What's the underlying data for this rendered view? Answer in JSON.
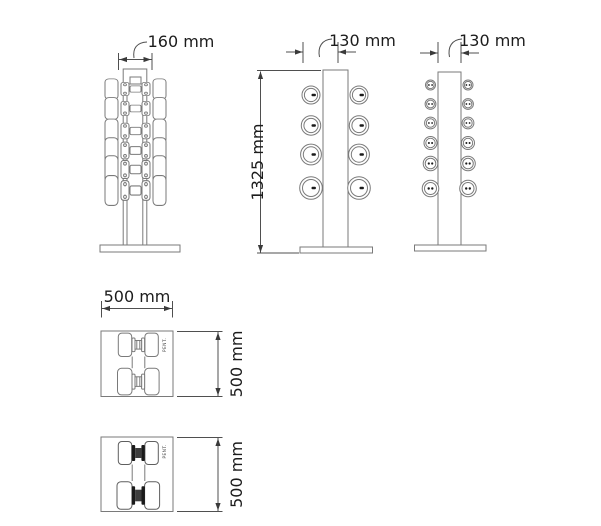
{
  "drawing": {
    "front_view": {
      "width": "160 mm"
    },
    "side_view_a": {
      "depth": "130 mm",
      "height": "1325 mm"
    },
    "side_view_b": {
      "depth": "130 mm"
    },
    "top_view_a": {
      "width": "500 mm",
      "depth": "500 mm",
      "brand": "PENT."
    },
    "top_view_b": {
      "depth": "500 mm",
      "brand": "PENT."
    },
    "colors": {
      "line": "#7a7a7a",
      "dimension": "#4f4f4f",
      "text": "#1c1c1c"
    }
  }
}
